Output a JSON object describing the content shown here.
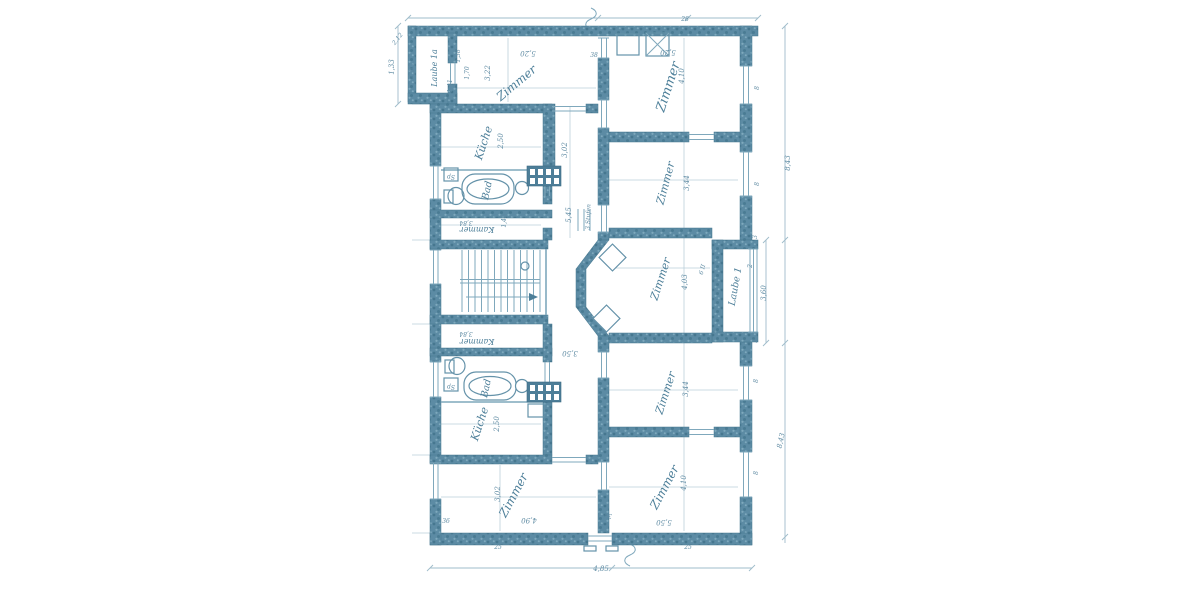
{
  "drawing": {
    "kind": "scanned architectural floor plan (blueprint, German labels)",
    "floors_shown": 1,
    "apartments": 2
  },
  "colors": {
    "paper": "#ffffff",
    "ink": "#4d7f99",
    "wall_fill": "#58889f",
    "faint_line": "#aec7d4"
  },
  "rooms": [
    {
      "id": "laube-1a",
      "label": "Laube 1a"
    },
    {
      "id": "zimmer-top-left",
      "label": "Zimmer"
    },
    {
      "id": "kueche-upper",
      "label": "Küche"
    },
    {
      "id": "bad-upper",
      "label": "Bad"
    },
    {
      "id": "kammer-upper",
      "label": "Kammer"
    },
    {
      "id": "zimmer-top-right",
      "label": "Zimmer"
    },
    {
      "id": "zimmer-right-2",
      "label": "Zimmer"
    },
    {
      "id": "zimmer-right-3",
      "label": "Zimmer"
    },
    {
      "id": "laube-1",
      "label": "Laube 1"
    },
    {
      "id": "kammer-lower",
      "label": "Kammer"
    },
    {
      "id": "bad-lower",
      "label": "Bad"
    },
    {
      "id": "kueche-lower",
      "label": "Küche"
    },
    {
      "id": "zimmer-bottom-left",
      "label": "Zimmer"
    },
    {
      "id": "zimmer-right-4",
      "label": "Zimmer"
    },
    {
      "id": "zimmer-bottom-right",
      "label": "Zimmer"
    }
  ],
  "annotations": {
    "stairs_note": "3 Stufen",
    "loggia_note": "6 II",
    "sink_abbr": "Sp"
  },
  "dims": {
    "laube1a_depth": "2,85",
    "laube1a_door": "1,38",
    "d170": "1,70",
    "d141": "1,41",
    "left_small": "1,33",
    "left_diag": "2,12",
    "room_tl_w": "5,20",
    "room_tl_h": "3,22",
    "kitchen_w": "2,50",
    "hall_w": "3,02",
    "hall_h": "5,45",
    "kammer_w": "3,84",
    "kammer_h": "1,45",
    "room_tr_w": "5,20",
    "room_tr_h": "4,10",
    "room_r2_h": "3,44",
    "room_r3_h": "4,03",
    "room_r3_w": "3,50",
    "laube1_h": "3,60",
    "laube1_w": "2",
    "room_bl_h": "3,02",
    "room_bl_w": "4,90",
    "room_r4_h": "3,44",
    "room_r5_h": "4,10",
    "room_r5_w": "5,50",
    "right_total": "8,43",
    "bottom_total": "4,85",
    "wall_25": "25",
    "wall_28": "28",
    "wall_38": "38",
    "wall_36": "36",
    "win_8": "8",
    "corner_3": "3"
  }
}
